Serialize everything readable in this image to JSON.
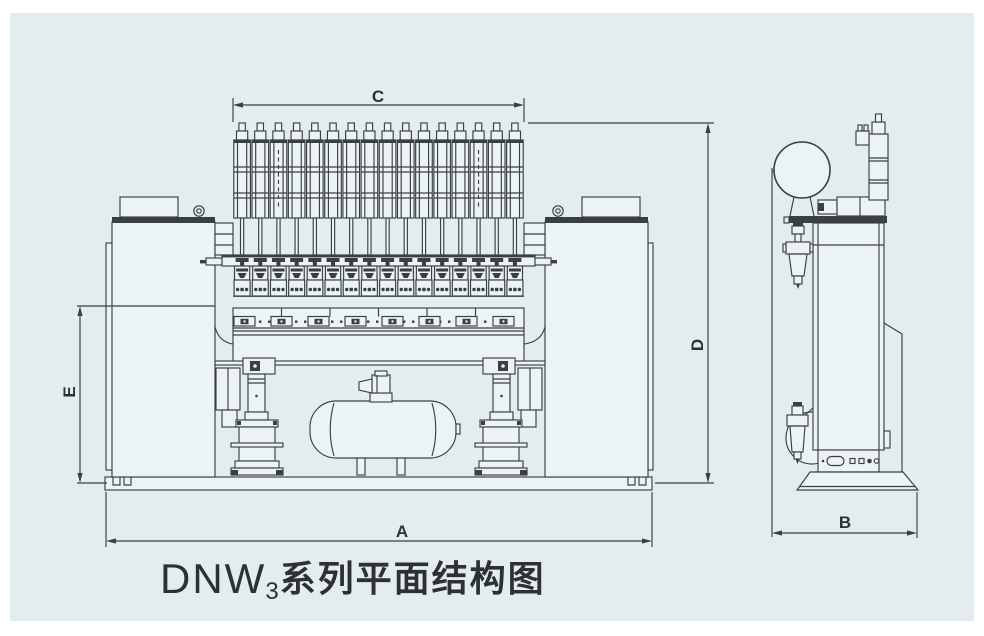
{
  "title": {
    "prefix": "DNW",
    "sub": "3",
    "suffix": "系列平面结构图"
  },
  "dims": {
    "A": "A",
    "B": "B",
    "C": "C",
    "D": "D",
    "E": "E"
  },
  "colors": {
    "canvas": "#ffffff",
    "panel": "#e3edee",
    "line": "#3a3f43",
    "machine_fill": "#ecf3f4",
    "text": "#2d3134"
  },
  "machine": {
    "top_cylinder_count": 16,
    "electrode_count": 16,
    "beam_clamp_count": 8
  }
}
